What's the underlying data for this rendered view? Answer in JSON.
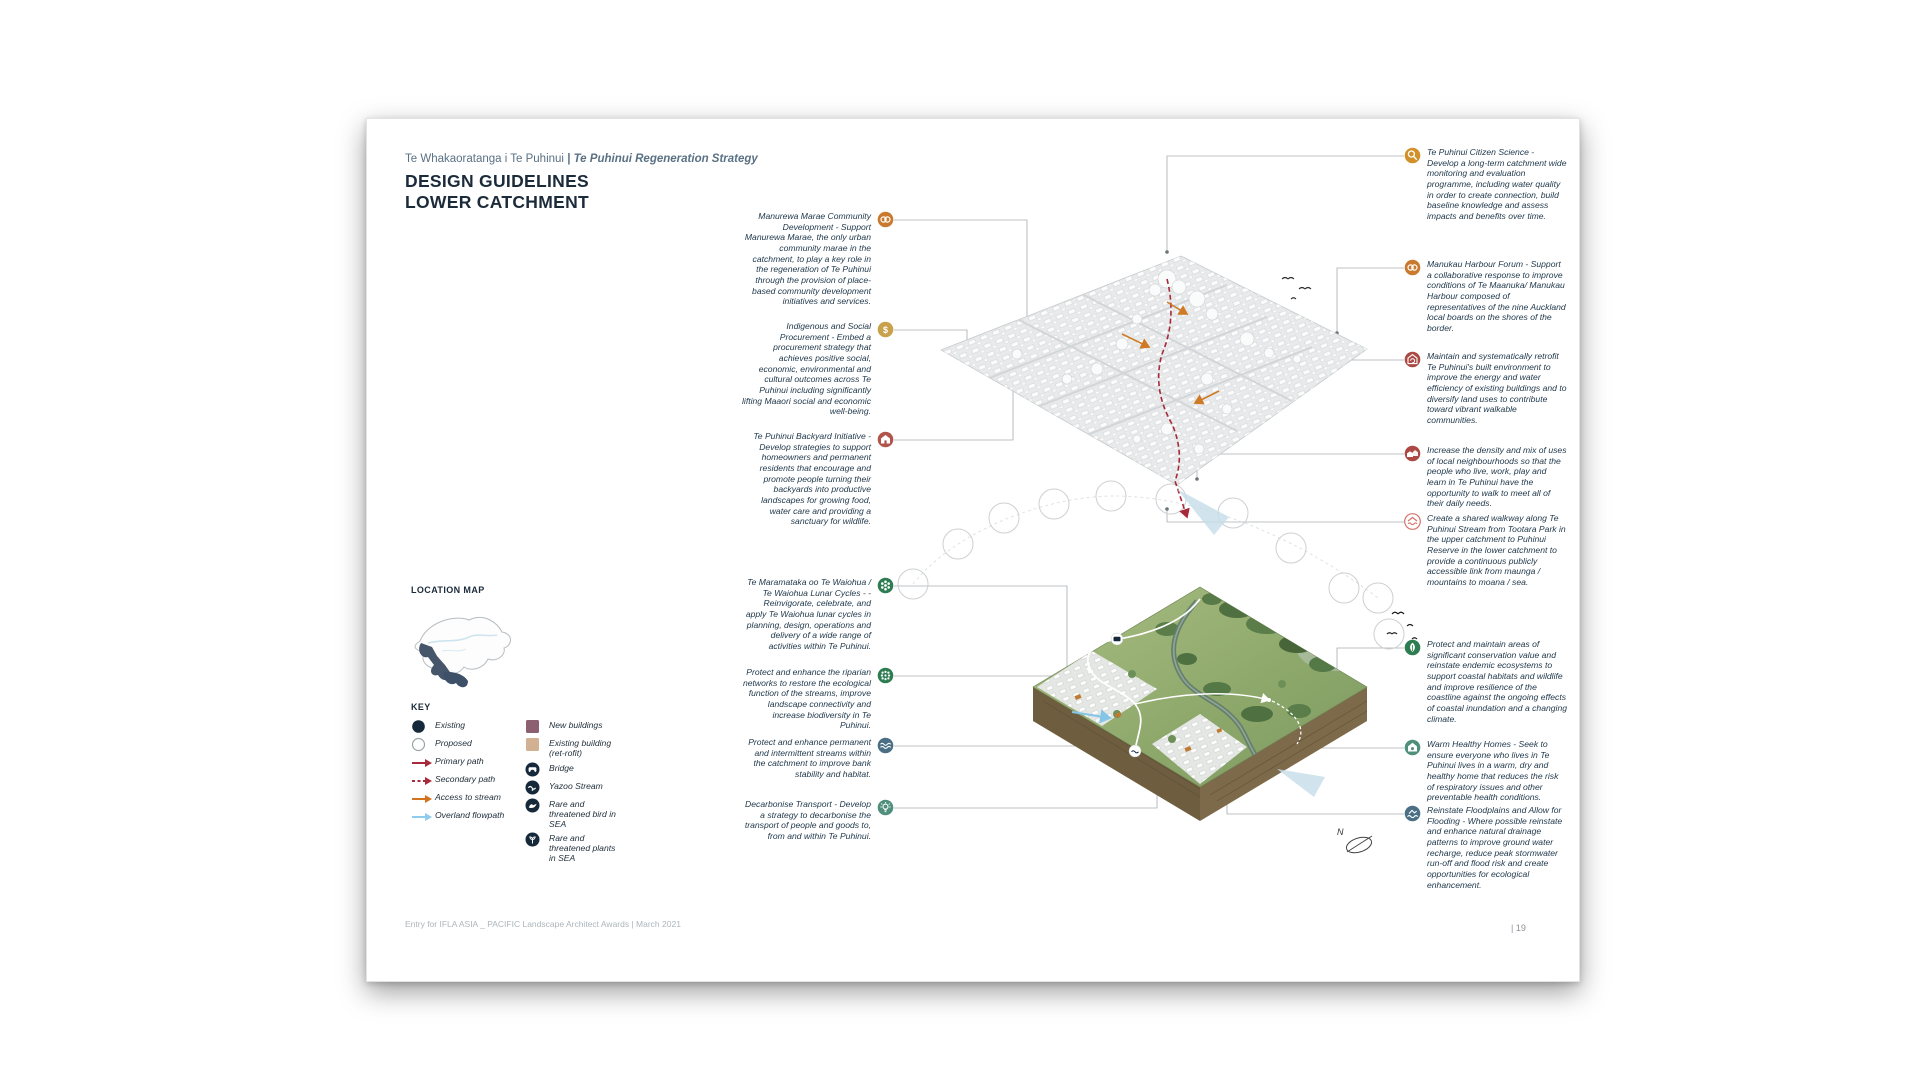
{
  "page": {
    "kicker_part1": "Te Whakaoratanga i Te Puhinui ",
    "kicker_part2": "| Te Puhinui Regeneration Strategy",
    "title_line1": "DESIGN GUIDELINES",
    "title_line2": "LOWER CATCHMENT",
    "footer": "Entry for IFLA ASIA _ PACIFIC  Landscape Architect Awards | March 2021",
    "page_number": "| 19"
  },
  "location_map": {
    "label": "LOCATION MAP"
  },
  "figure": {
    "north_label": "N"
  },
  "key": {
    "label": "KEY",
    "items_left": [
      {
        "icon": "existing-dot",
        "glyph": "dot-filled",
        "color": "#16293b",
        "label": "Existing"
      },
      {
        "icon": "proposed-dot",
        "glyph": "dot-outline",
        "color": "#9aa3a8",
        "label": "Proposed"
      },
      {
        "icon": "primary-path-arrow",
        "glyph": "arrow-solid",
        "color": "#a72a3b",
        "label": "Primary path"
      },
      {
        "icon": "secondary-path-arrow",
        "glyph": "arrow-dashed",
        "color": "#a72a3b",
        "label": "Secondary path"
      },
      {
        "icon": "access-to-stream-arrow",
        "glyph": "arrow-solid",
        "color": "#d4731d",
        "label": "Access to stream"
      },
      {
        "icon": "overland-flowpath-arrow",
        "glyph": "arrow-solid",
        "color": "#8fcbec",
        "label": "Overland flowpath"
      }
    ],
    "items_right": [
      {
        "icon": "new-buildings-swatch",
        "glyph": "swatch",
        "color": "#8c6070",
        "label": "New buildings"
      },
      {
        "icon": "existing-building-retrofit-swatch",
        "glyph": "swatch",
        "color": "#d2b193",
        "label": "Existing building (ret-rofit)"
      },
      {
        "icon": "bridge-badge",
        "glyph": "badge-bridge",
        "color": "#16293b",
        "label": "Bridge"
      },
      {
        "icon": "yazoo-stream-badge",
        "glyph": "badge-wave",
        "color": "#16293b",
        "label": "Yazoo Stream"
      },
      {
        "icon": "rare-bird-badge",
        "glyph": "badge-bird",
        "color": "#16293b",
        "label": "Rare and threatened bird in SEA"
      },
      {
        "icon": "rare-plants-badge",
        "glyph": "badge-plant",
        "color": "#16293b",
        "label": "Rare and threatened plants in SEA"
      }
    ]
  },
  "annotations_left": [
    {
      "icon": "marae-community-icon",
      "glyph": "handshake",
      "bg": "#c97a2e",
      "text": "Manurewa Marae Community Development - Support Manurewa Marae, the only urban community marae in the catchment, to play a key role in the regeneration of Te Puhinui through the provision of place-based community development initiatives and services."
    },
    {
      "icon": "indigenous-procurement-dollar-icon",
      "glyph": "dollar",
      "bg": "#c9a14c",
      "text": "Indigenous and Social Procurement - Embed a procurement strategy that achieves positive social, economic, environmental and cultural outcomes across Te Puhinui including significantly lifting Maaori social and economic well-being."
    },
    {
      "icon": "backyard-house-icon",
      "glyph": "house",
      "bg": "#b0544c",
      "text": "Te Puhinui Backyard Initiative - Develop strategies to support homeowners and permanent residents that encourage and promote people turning their backyards into productive landscapes for growing food, water care and providing a sanctuary for wildlife."
    },
    {
      "icon": "lunar-cycles-flower-icon",
      "glyph": "flower",
      "bg": "#2e7d52",
      "text": "Te Maramataka oo Te Waiohua / Te Waiohua Lunar Cycles - -Reinvigorate, celebrate, and apply Te Waiohua lunar cycles in planning, design, operations and delivery of a wide range of activities within Te Puhinui."
    },
    {
      "icon": "riparian-networks-icon",
      "glyph": "leafcluster",
      "bg": "#2e7d52",
      "text": "Protect and enhance the riparian networks to restore the ecological function of the streams, improve landscape connectivity and increase biodiversity in Te Puhinui."
    },
    {
      "icon": "streams-wave-icon",
      "glyph": "wave2",
      "bg": "#4b7086",
      "text": "Protect and enhance permanent and intermittent streams within the catchment to improve bank stability and habitat."
    },
    {
      "icon": "decarbonise-transport-bulb-icon",
      "glyph": "bulb",
      "bg": "#4f8f7b",
      "text": "Decarbonise Transport - Develop a strategy to decarbonise the transport of people and goods to, from and within Te Puhinui."
    }
  ],
  "annotations_right": [
    {
      "icon": "citizen-science-magnifier-icon",
      "glyph": "magnifier",
      "bg": "#d0912b",
      "text": "Te Puhinui Citizen Science - Develop a long-term catchment wide monitoring and evaluation programme, including water quality in order to create connection, build baseline knowledge and assess impacts and benefits over time."
    },
    {
      "icon": "harbour-forum-icon",
      "glyph": "handshake",
      "bg": "#c97a2e",
      "text": "Manukau Harbour Forum - Support a collaborative response to improve conditions of Te Maanuka/ Manukau Harbour composed of representatives of the nine Auckland local boards on the shores of the border."
    },
    {
      "icon": "retrofit-building-icon",
      "glyph": "retrofit",
      "bg": "#ab4a44",
      "text": "Maintain and systematically retrofit Te Puhinui's built environment to improve the energy and water efficiency of existing buildings and to diversify land uses to contribute toward vibrant walkable communities."
    },
    {
      "icon": "density-housing-icon",
      "glyph": "houses",
      "bg": "#ab4a44",
      "text": "Increase the density and mix of uses of local neighbourhoods so that the people who live, work, play and learn in Te Puhinui have the opportunity to walk to meet all of their daily needs."
    },
    {
      "icon": "shared-walkway-icon",
      "glyph": "walkway",
      "bg": "#ffffff",
      "ring": "#d4726a",
      "fg": "#d4726a",
      "text": "Create a shared walkway along Te Puhinui Stream from Tootara Park in the upper catchment to Puhinui Reserve in the lower catchment to provide a continuous publicly accessible link from maunga / mountains to moana / sea."
    },
    {
      "icon": "conservation-leaf-icon",
      "glyph": "leaf",
      "bg": "#2e7d52",
      "text": "Protect and maintain areas of significant conservation value and reinstate endemic ecosystems to support coastal habitats and wildlife and improve resilience of the coastline against the ongoing effects of coastal inundation and a changing climate."
    },
    {
      "icon": "healthy-homes-icon",
      "glyph": "househeart",
      "bg": "#4f8f7b",
      "text": "Warm Healthy Homes - Seek to ensure everyone who lives in Te Puhinui lives in a warm, dry and healthy home that reduces the risk of respiratory issues and other preventable health conditions."
    },
    {
      "icon": "floodplains-icon",
      "glyph": "floodwave",
      "bg": "#4b7086",
      "text": "Reinstate Floodplains and Allow for Flooding - Where possible reinstate and enhance natural drainage patterns to improve ground water recharge, reduce peak stormwater run-off and flood risk and create opportunities for ecological enhancement."
    }
  ],
  "colors": {
    "title": "#1c2b3a",
    "kicker": "#5a7184",
    "annotation_text": "#223a4c",
    "leader_line": "#a6adb2",
    "primary_path": "#a72a3b",
    "access_path": "#d4731d",
    "overland_flowpath": "#8fcbec",
    "legend_navy": "#16293b"
  }
}
